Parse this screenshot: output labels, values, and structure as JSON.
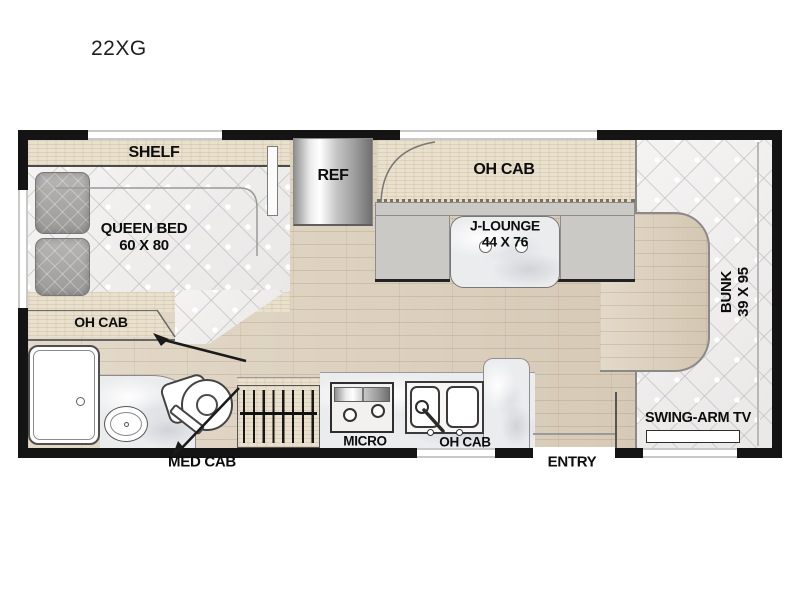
{
  "title": "22XG",
  "colors": {
    "wall": "#141414",
    "floor_wood": "#dccfba",
    "cabinet_wood": "#e9e0cd",
    "mattress": "#f1f0ef",
    "bench_gray": "#cbc9c5",
    "marble": "#ebecee"
  },
  "bedroom": {
    "shelf_label": "SHELF",
    "bed_label": "QUEEN BED",
    "bed_size": "60 X 80",
    "oh_cab_label": "OH CAB"
  },
  "kitchen": {
    "ref_label": "REF",
    "micro_label": "MICRO",
    "oh_cab_label": "OH CAB",
    "med_cab_label": "MED CAB"
  },
  "dinette": {
    "oh_cab_label": "OH CAB",
    "lounge_label": "J-LOUNGE",
    "lounge_size": "44 X 76"
  },
  "front": {
    "bunk_label": "BUNK",
    "bunk_size": "39 X 95",
    "tv_label": "SWING-ARM TV",
    "entry_label": "ENTRY"
  }
}
